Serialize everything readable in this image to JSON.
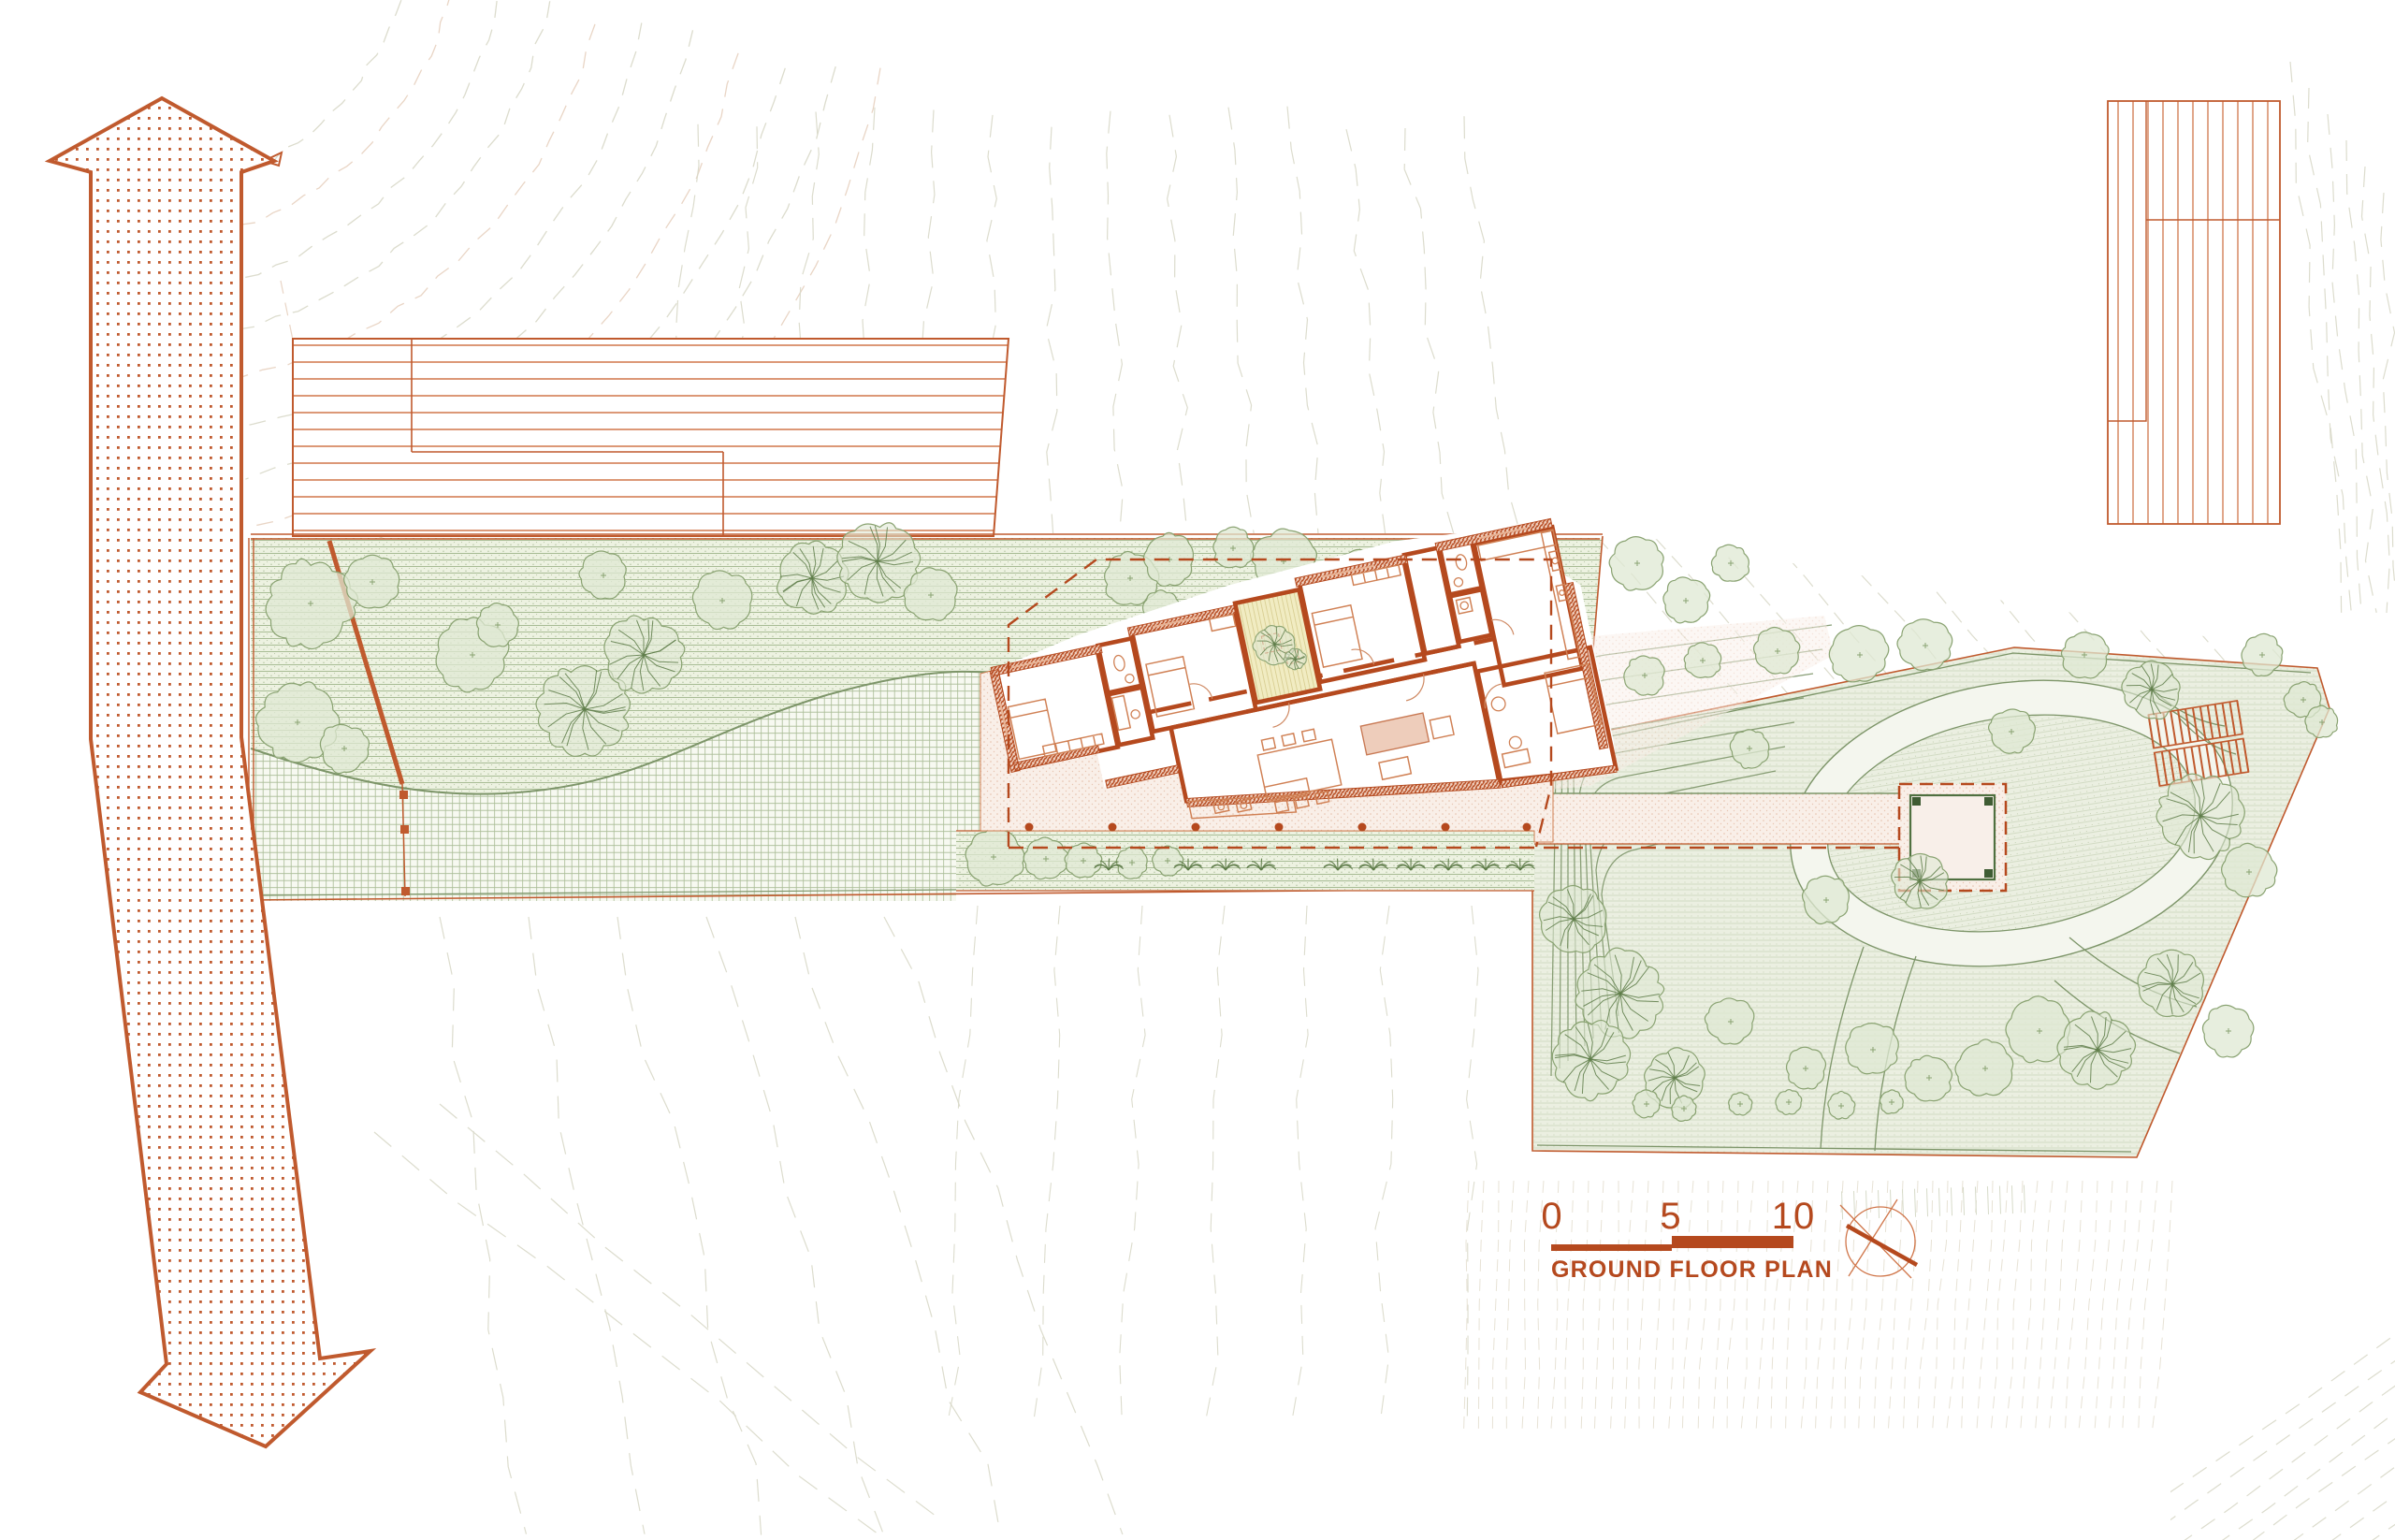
{
  "drawing": {
    "label": "GROUND FLOOR PLAN",
    "type_note": "architectural site / ground floor plan",
    "icons": {
      "north_icon": "north-arrow-icon",
      "road_icon": "two-headed-road-arrow-icon"
    }
  },
  "scale_bar": {
    "labels": [
      "0",
      "5",
      "10"
    ]
  },
  "colors": {
    "accent": "#b5491e",
    "accent_soft": "#c05a2e",
    "hatch_orange": "#d0764a",
    "furn_line": "#d08054",
    "pink_bg": "#f9efe8",
    "pink_dot": "#e2b49c",
    "wall_fill": "#f3d6c6",
    "green_line": "#7d9569",
    "meadow_line": "#a0b68c",
    "meadow_bg": "#edf2e1",
    "stipple": "#87a070",
    "grid_bg": "#f7f9f1",
    "grid_line": "#a9bc95",
    "garden_bg": "#ebefe1",
    "garden_line": "#ccd6bd",
    "tree_stroke": "#8aa372",
    "tree_fill": "#dfe8d3",
    "tree_dark": "#5e7c49",
    "courtyard_fill": "#f1ecc2",
    "courtyard_line": "#d9cf94",
    "pavilion_green": "#4f7040",
    "contour_gray": "#d8d8c8",
    "contour_warm": "#e7d0bf",
    "faint_line": "#e6e0d3"
  }
}
